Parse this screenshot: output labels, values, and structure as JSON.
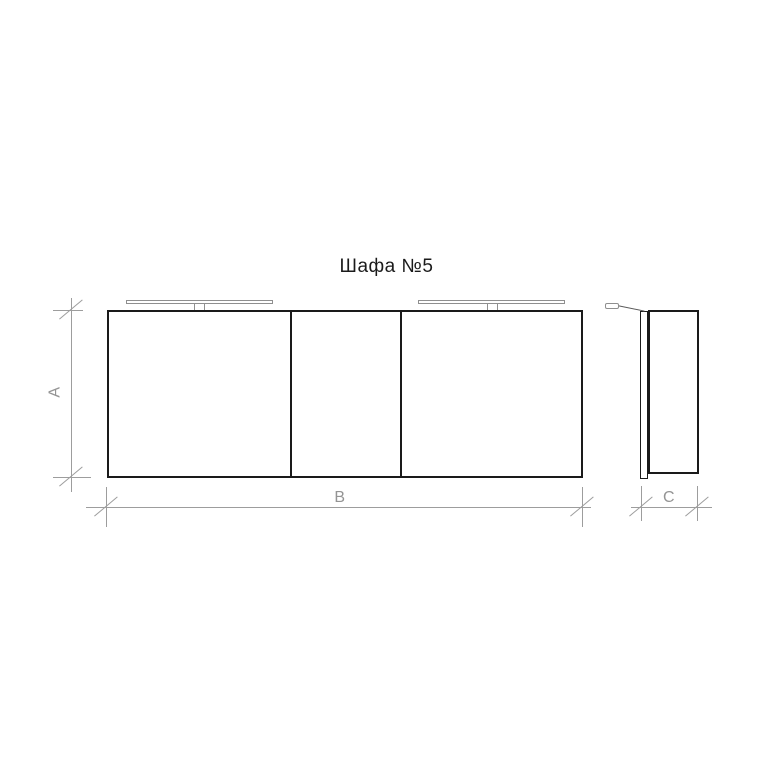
{
  "title": "Шафа №5",
  "dimension_labels": {
    "height": "A",
    "width": "B",
    "depth": "C"
  },
  "colors": {
    "outline": "#1a1a1a",
    "dimension": "#9d9d9d",
    "light_fixture": "#8f8f8f",
    "background": "#ffffff"
  }
}
